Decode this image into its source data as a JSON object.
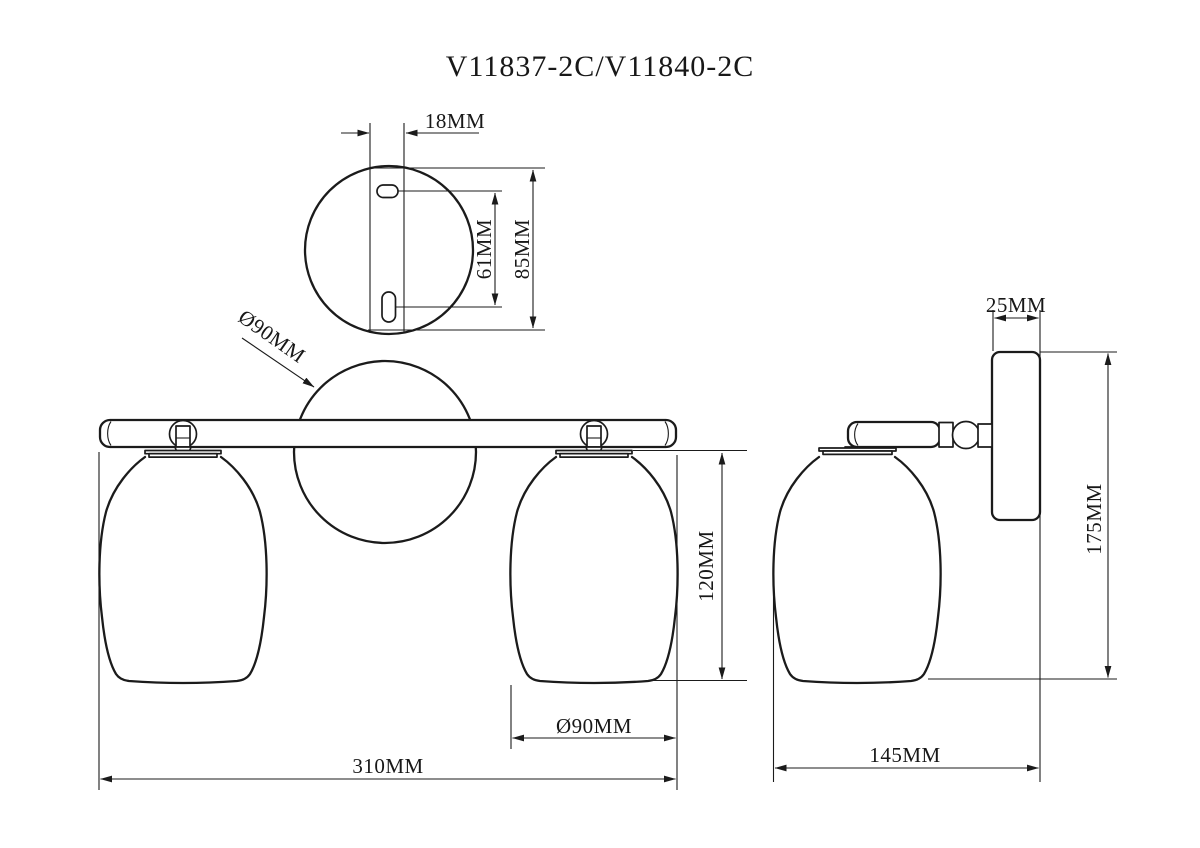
{
  "title": "V11837-2C/V11840-2C",
  "colors": {
    "ink": "#1b1b1b",
    "background": "#ffffff"
  },
  "views": {
    "mounting_plate": {
      "label": "mounting-plate-detail",
      "dims": {
        "slot_offset": "18MM",
        "slot_spacing": "61MM",
        "plate_diameter": "85MM"
      }
    },
    "front": {
      "label": "front-view",
      "dims": {
        "canopy_diameter": "Ø90MM",
        "shade_height": "120MM",
        "shade_diameter": "Ø90MM",
        "overall_width": "310MM"
      }
    },
    "side": {
      "label": "side-view",
      "dims": {
        "backplate_depth": "25MM",
        "overall_height": "175MM",
        "projection": "145MM"
      }
    }
  }
}
